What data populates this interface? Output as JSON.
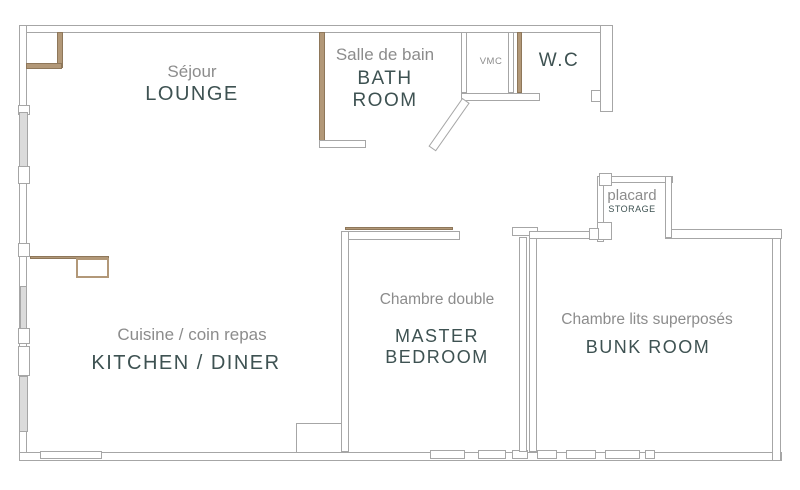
{
  "plan": {
    "title": "apartment-floor-plan",
    "rooms": {
      "lounge": {
        "fr": "Séjour",
        "en": "LOUNGE"
      },
      "bathroom": {
        "fr": "Salle de bain",
        "en_line1": "BATH",
        "en_line2": "ROOM"
      },
      "vmc": {
        "label": "VMC"
      },
      "wc": {
        "label": "W.C"
      },
      "storage": {
        "fr": "placard",
        "en": "STORAGE"
      },
      "kitchen": {
        "fr": "Cuisine / coin repas",
        "en": "KITCHEN / DINER"
      },
      "master_bedroom": {
        "fr": "Chambre double",
        "en_line1": "MASTER",
        "en_line2": "BEDROOM"
      },
      "bunk_room": {
        "fr": "Chambre lits superposés",
        "en": "BUNK ROOM"
      }
    },
    "colors": {
      "wall_line": "#a6a6a6",
      "wood_accent": "#b29878",
      "label_french": "#8c8c8c",
      "label_english": "#3e5252",
      "window_fill": "#dbdbdb",
      "background": "#ffffff"
    }
  }
}
